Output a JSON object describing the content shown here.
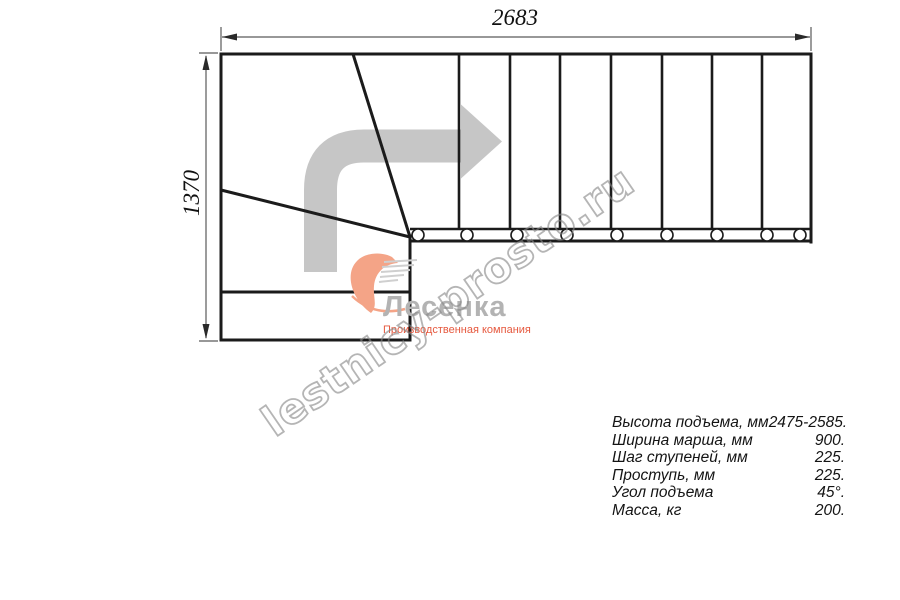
{
  "drawing": {
    "title_hint": "staircase-plan",
    "dimensions": {
      "width_mm": "2683",
      "height_mm": "1370"
    }
  },
  "specs": {
    "rows": [
      {
        "label": "Высота подъема, мм",
        "value": "2475-2585."
      },
      {
        "label": "Ширина марша, мм",
        "value": "900."
      },
      {
        "label": "Шаг ступеней, мм",
        "value": "225."
      },
      {
        "label": "Проступь, мм",
        "value": "225."
      },
      {
        "label": "Угол подъема",
        "value": "45°."
      },
      {
        "label": "Масса, кг",
        "value": "200."
      }
    ]
  },
  "logo": {
    "name": "Лесенка",
    "tagline": "Производственная компания"
  },
  "watermark": {
    "text": "lestnicy-prosto.ru"
  },
  "colors": {
    "line": "#1b1b1b",
    "dimension_line": "#5a5a5a",
    "direction_arrow": "#c6c6c6",
    "logo_text_gray": "#b3b3b3",
    "logo_swoosh_orange": "#f4a487",
    "tagline_orange": "#e6593f",
    "watermark_gray": "#878787"
  }
}
